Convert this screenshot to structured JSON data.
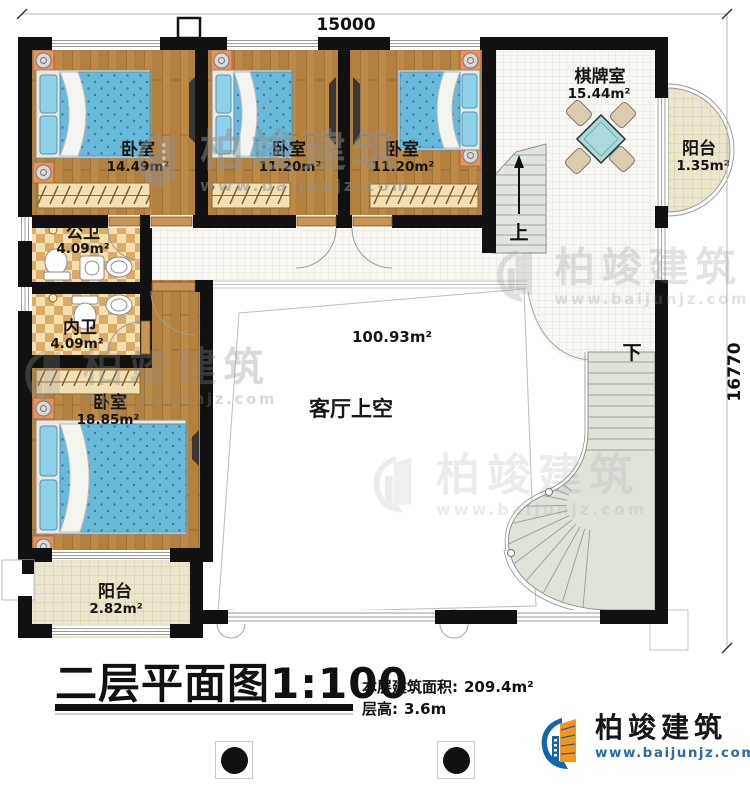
{
  "plan": {
    "dimension_top": "15000",
    "dimension_right": "16770",
    "stair_up": "上",
    "stair_down": "下",
    "rooms": [
      {
        "name": "卧室",
        "area": "14.49m²"
      },
      {
        "name": "卧室",
        "area": "11.20m²"
      },
      {
        "name": "卧室",
        "area": "11.20m²"
      },
      {
        "name": "棋牌室",
        "area": "15.44m²"
      },
      {
        "name": "阳台",
        "area": "1.35m²"
      },
      {
        "name": "公卫",
        "area": "4.09m²"
      },
      {
        "name": "内卫",
        "area": "4.09m²"
      },
      {
        "name": "卧室",
        "area": "18.85m²"
      },
      {
        "name": "阳台",
        "area": "2.82m²"
      },
      {
        "name": "客厅上空",
        "area": "100.93m²"
      }
    ]
  },
  "title_block": {
    "title": "二层平面图",
    "scale": "1:100",
    "area_label": "本层建筑面积:",
    "area_value": "209.4m²",
    "height_label": "层高:",
    "height_value": "3.6m"
  },
  "watermark": {
    "brand": "柏竣建筑",
    "url": "www.baijunjz.com"
  },
  "logo": {
    "brand": "柏竣建筑",
    "url": "www.baijunjz.com"
  },
  "colors": {
    "wall": "#111111",
    "wood": "#b3813f",
    "accent_blue": "#1763ad",
    "accent_orange": "#f7941d",
    "logo_url_blue": "#2c6ba5"
  }
}
